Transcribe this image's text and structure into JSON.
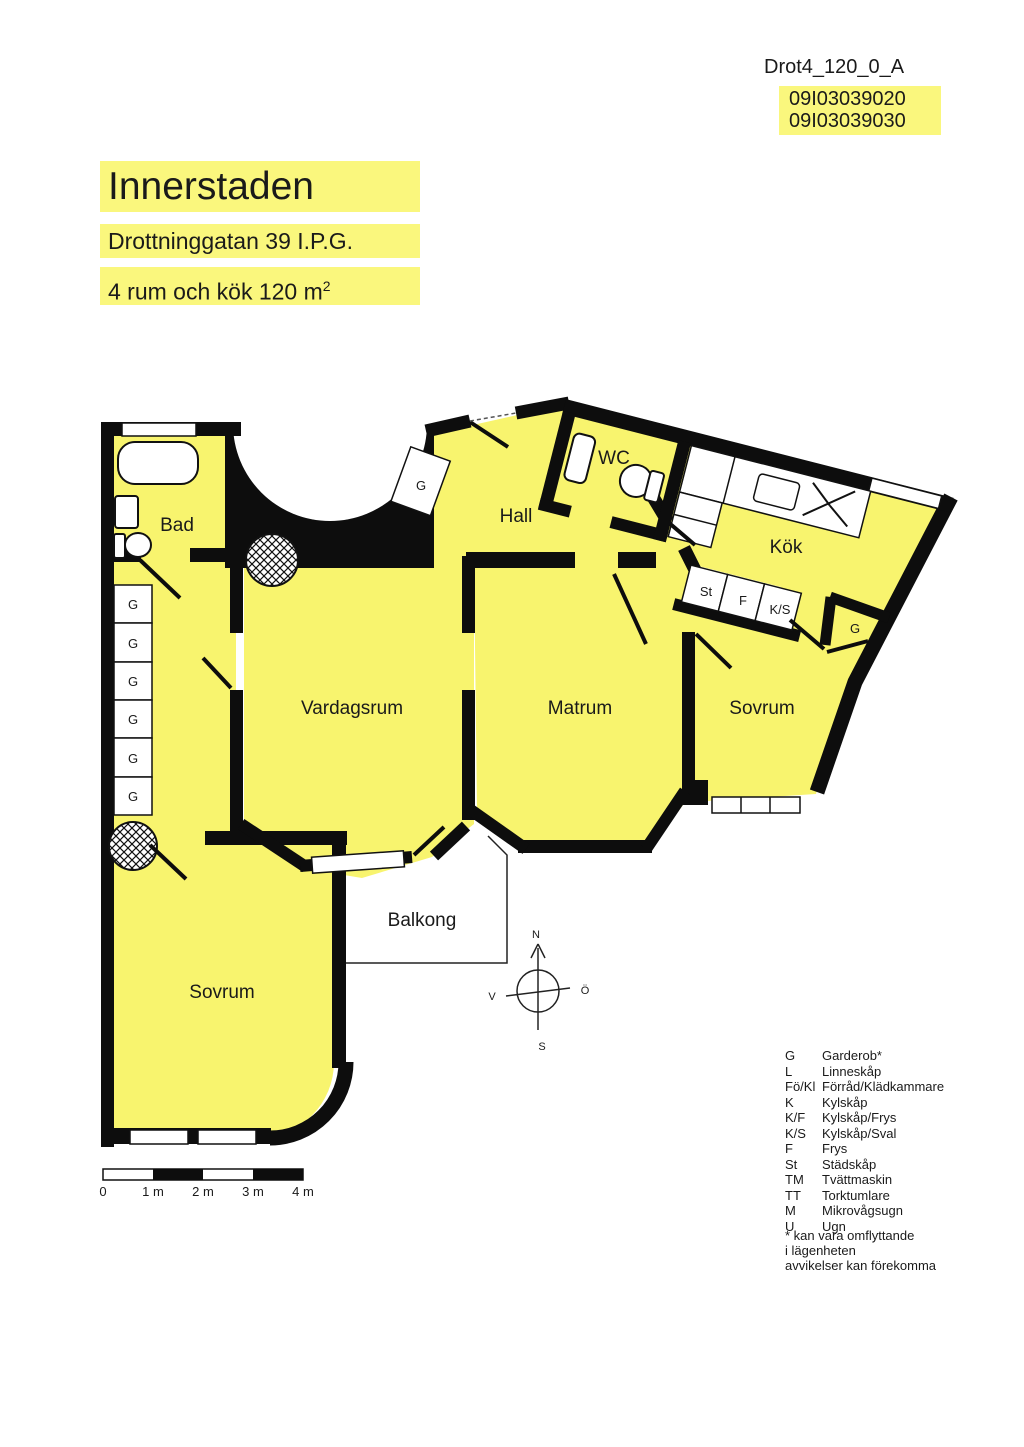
{
  "header": {
    "doc_id": "Drot4_120_0_A",
    "plan_numbers": [
      "09I03039020",
      "09I03039030"
    ]
  },
  "title": {
    "area": "Innerstaden",
    "address": "Drottninggatan 39 I.P.G.",
    "size_prefix": "4 rum och kök 120 m",
    "size_sup": "2"
  },
  "rooms": {
    "bad": "Bad",
    "hall": "Hall",
    "wc": "WC",
    "kok": "Kök",
    "vardagsrum": "Vardagsrum",
    "matrum": "Matrum",
    "sovrum_right": "Sovrum",
    "sovrum_left": "Sovrum",
    "balkong": "Balkong"
  },
  "closets": {
    "garderob": "G",
    "stadskap": "St",
    "frys": "F",
    "kyl_sval": "K/S"
  },
  "compass": {
    "north": "N",
    "south": "S",
    "west": "V",
    "east": "Ö"
  },
  "scale_bar": {
    "labels": [
      "0",
      "1 m",
      "2 m",
      "3 m",
      "4 m"
    ]
  },
  "legend": {
    "rows": [
      {
        "key": "G",
        "label": "Garderob*"
      },
      {
        "key": "L",
        "label": "Linneskåp"
      },
      {
        "key": "Fö/Kl",
        "label": "Förråd/Klädkammare"
      },
      {
        "key": "K",
        "label": "Kylskåp"
      },
      {
        "key": "K/F",
        "label": "Kylskåp/Frys"
      },
      {
        "key": "K/S",
        "label": "Kylskåp/Sval"
      },
      {
        "key": "F",
        "label": "Frys"
      },
      {
        "key": "St",
        "label": "Städskåp"
      },
      {
        "key": "TM",
        "label": "Tvättmaskin"
      },
      {
        "key": "TT",
        "label": "Torktumlare"
      },
      {
        "key": "M",
        "label": "Mikrovågsugn"
      },
      {
        "key": "U",
        "label": "Ugn"
      }
    ]
  },
  "footnote": {
    "lines": [
      "* kan vara omflyttande",
      "i lägenheten",
      "avvikelser kan förekomma"
    ]
  },
  "colors": {
    "room_yellow": "#F8F46E",
    "highlight_yellow": "#FAF77D",
    "wall_black": "#0d0d0d"
  }
}
